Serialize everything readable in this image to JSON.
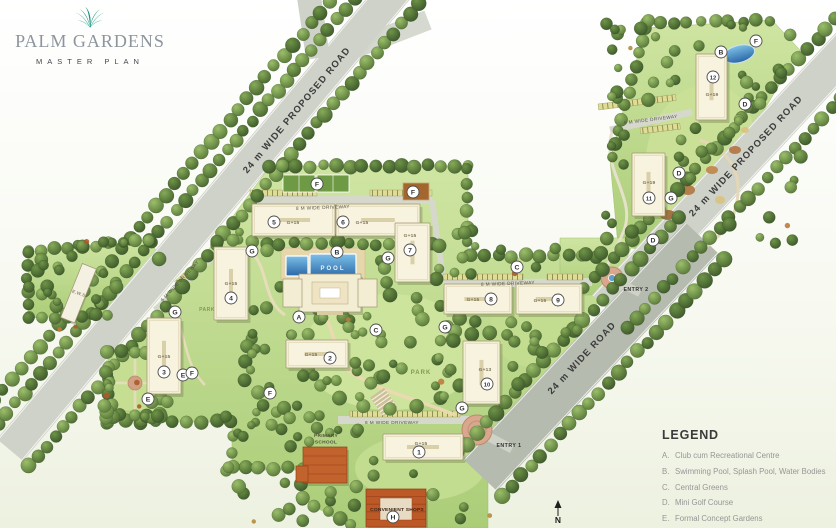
{
  "logo": {
    "title": "PALM GARDENS",
    "subtitle": "MASTER PLAN"
  },
  "legend": {
    "title": "LEGEND",
    "items": [
      {
        "key": "A",
        "label": "Club cum Recreational Centre"
      },
      {
        "key": "B",
        "label": "Swimming Pool, Splash Pool, Water Bodies"
      },
      {
        "key": "C",
        "label": "Central Greens"
      },
      {
        "key": "D",
        "label": "Mini Golf Course"
      },
      {
        "key": "E",
        "label": "Formal Concept Gardens"
      },
      {
        "key": "F",
        "label": "Recreational Zones"
      }
    ]
  },
  "colors": {
    "accent_teal": "#1ca28c",
    "site_green": "#b7d584",
    "road_gray": "#cfd2c8",
    "wide_road_gray": "#b6bbb0",
    "pool_blue": "#3d7fc0",
    "roof_orange": "#c05a2a",
    "building_cream": "#f3edd3"
  },
  "map": {
    "roads": [
      {
        "name": "proposed-road-left",
        "label": "24 m WIDE PROPOSED ROAD",
        "x1": 10,
        "y1": 450,
        "x2": 399,
        "y2": -14,
        "w": 34,
        "lx": 299,
        "ly": 112,
        "rot": -50
      },
      {
        "name": "proposed-road-right",
        "label": "24 m WIDE PROPOSED ROAD",
        "x1": 606,
        "y1": 308,
        "x2": 857,
        "y2": 38,
        "w": 38,
        "lx": 748,
        "ly": 158,
        "rot": -47
      },
      {
        "name": "wide-road",
        "label": "24 m WIDE ROAD",
        "x1": 480,
        "y1": 475,
        "x2": 702,
        "y2": 238,
        "w": 46,
        "lx": 584,
        "ly": 360,
        "rot": -47
      }
    ],
    "driveway_labels": [
      {
        "text": "8 M WIDE DRIVEWAY",
        "x": 323,
        "y": 209,
        "rot": -2
      },
      {
        "text": "8 M WIDE DRIVEWAY",
        "x": 508,
        "y": 285,
        "rot": -2
      },
      {
        "text": "8 M WIDE DRIVEWAY",
        "x": 392,
        "y": 424,
        "rot": 0
      },
      {
        "text": "8 M WIDE DRIVEWAY",
        "x": 651,
        "y": 121,
        "rot": -7
      },
      {
        "text": "6 M WIDE DRIVEWAY",
        "x": 181,
        "y": 282,
        "rot": -47
      }
    ],
    "entries": [
      {
        "label": "ENTRY 1",
        "x": 509,
        "y": 447
      },
      {
        "label": "ENTRY 2",
        "x": 636,
        "y": 291
      }
    ],
    "buildings": [
      {
        "num": "1",
        "floors": "G+15",
        "x": 383,
        "y": 434,
        "w": 80,
        "h": 26,
        "nx": 419,
        "ny": 452,
        "fx": 421,
        "fy": 445
      },
      {
        "num": "2",
        "floors": "G+15",
        "x": 286,
        "y": 340,
        "w": 62,
        "h": 28,
        "nx": 330,
        "ny": 358,
        "fx": 311,
        "fy": 356
      },
      {
        "num": "3",
        "floors": "G+15",
        "x": 147,
        "y": 318,
        "w": 34,
        "h": 76,
        "nx": 164,
        "ny": 372,
        "fx": 164,
        "fy": 358
      },
      {
        "num": "4",
        "floors": "G+15",
        "x": 214,
        "y": 247,
        "w": 34,
        "h": 73,
        "nx": 231,
        "ny": 298,
        "fx": 231,
        "fy": 285
      },
      {
        "num": "5",
        "floors": "G+15",
        "x": 252,
        "y": 204,
        "w": 83,
        "h": 32,
        "nx": 274,
        "ny": 222,
        "fx": 293,
        "fy": 224
      },
      {
        "num": "6",
        "floors": "G+15",
        "x": 336,
        "y": 204,
        "w": 84,
        "h": 32,
        "nx": 343,
        "ny": 222,
        "fx": 362,
        "fy": 224
      },
      {
        "num": "7",
        "floors": "G+15",
        "x": 395,
        "y": 223,
        "w": 35,
        "h": 59,
        "nx": 410,
        "ny": 250,
        "fx": 410,
        "fy": 237
      },
      {
        "num": "8",
        "floors": "G+15",
        "x": 444,
        "y": 284,
        "w": 68,
        "h": 30,
        "nx": 491,
        "ny": 299,
        "fx": 473,
        "fy": 301
      },
      {
        "num": "9",
        "floors": "G+15",
        "x": 516,
        "y": 284,
        "w": 66,
        "h": 30,
        "nx": 558,
        "ny": 300,
        "fx": 540,
        "fy": 302
      },
      {
        "num": "10",
        "floors": "G+13",
        "x": 463,
        "y": 341,
        "w": 37,
        "h": 63,
        "nx": 487,
        "ny": 384,
        "fx": 485,
        "fy": 371
      },
      {
        "num": "11",
        "floors": "G+19",
        "x": 632,
        "y": 153,
        "w": 33,
        "h": 63,
        "nx": 649,
        "ny": 198,
        "fx": 649,
        "fy": 184
      },
      {
        "num": "12",
        "floors": "G+19",
        "x": 696,
        "y": 54,
        "w": 31,
        "h": 66,
        "nx": 713,
        "ny": 77,
        "fx": 712,
        "fy": 96
      }
    ],
    "letter_markers": [
      {
        "letter": "A",
        "x": 299,
        "y": 317
      },
      {
        "letter": "B",
        "x": 337,
        "y": 252
      },
      {
        "letter": "B",
        "x": 721,
        "y": 52
      },
      {
        "letter": "C",
        "x": 376,
        "y": 330
      },
      {
        "letter": "C",
        "x": 517,
        "y": 267
      },
      {
        "letter": "D",
        "x": 745,
        "y": 104
      },
      {
        "letter": "D",
        "x": 679,
        "y": 173
      },
      {
        "letter": "D",
        "x": 653,
        "y": 240
      },
      {
        "letter": "E",
        "x": 183,
        "y": 375
      },
      {
        "letter": "E",
        "x": 148,
        "y": 399
      },
      {
        "letter": "F",
        "x": 317,
        "y": 184
      },
      {
        "letter": "F",
        "x": 413,
        "y": 192
      },
      {
        "letter": "F",
        "x": 756,
        "y": 41
      },
      {
        "letter": "F",
        "x": 192,
        "y": 373
      },
      {
        "letter": "F",
        "x": 270,
        "y": 393
      },
      {
        "letter": "G",
        "x": 252,
        "y": 251
      },
      {
        "letter": "G",
        "x": 175,
        "y": 312
      },
      {
        "letter": "G",
        "x": 445,
        "y": 327
      },
      {
        "letter": "G",
        "x": 462,
        "y": 408
      },
      {
        "letter": "G",
        "x": 671,
        "y": 198
      },
      {
        "letter": "G",
        "x": 388,
        "y": 258
      },
      {
        "letter": "H",
        "x": 393,
        "y": 517
      }
    ],
    "site_labels": [
      {
        "text": "POOL",
        "x": 333,
        "y": 270,
        "s": 6,
        "c": "#e9f3fb",
        "ls": 2,
        "rot": 0
      },
      {
        "text": "PARK",
        "x": 421,
        "y": 374,
        "s": 6,
        "c": "#7e9c51",
        "ls": 1,
        "rot": 0
      },
      {
        "text": "PARK",
        "x": 207,
        "y": 311,
        "s": 5,
        "c": "#7e9c51",
        "ls": 0.5,
        "rot": 0
      },
      {
        "text": "PRIMARY",
        "x": 326,
        "y": 437,
        "s": 4.8,
        "c": "#514e3a",
        "ls": 0.3,
        "rot": 0
      },
      {
        "text": "SCHOOL",
        "x": 326,
        "y": 443.5,
        "s": 4.8,
        "c": "#514e3a",
        "ls": 0.3,
        "rot": 0
      },
      {
        "text": "CONVENIENT SHOPS",
        "x": 397,
        "y": 511,
        "s": 4.9,
        "c": "#3f2415",
        "ls": 0.2,
        "rot": 0
      },
      {
        "text": "E.W.S.",
        "x": 79,
        "y": 295,
        "s": 4.5,
        "c": "#8f8a6d",
        "ls": 0.3,
        "rot": 20
      }
    ],
    "compass": {
      "label": "N",
      "x": 558,
      "y": 523
    }
  }
}
